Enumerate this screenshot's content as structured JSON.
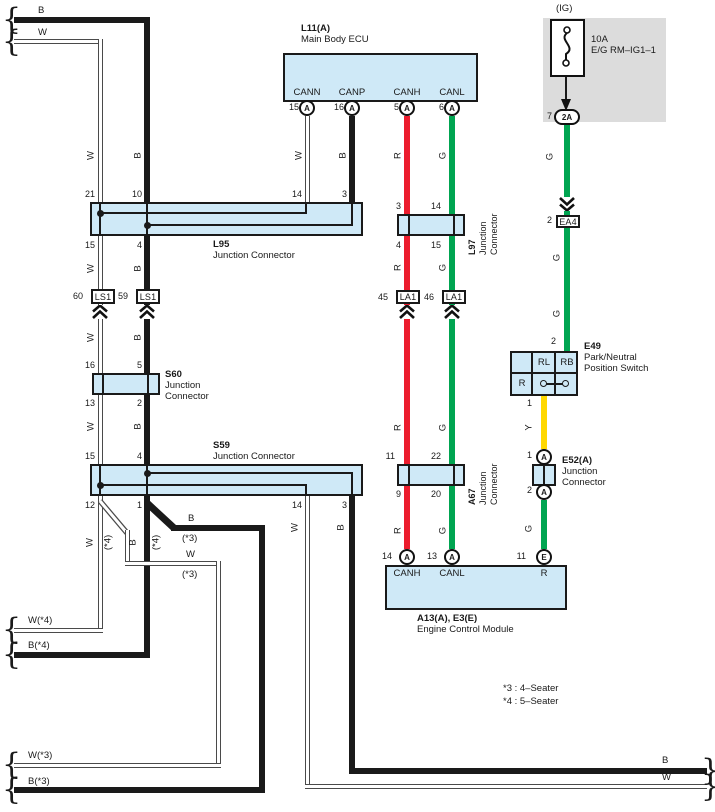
{
  "edge_labels": {
    "top_b": "B",
    "top_w": "W",
    "w4": "W(*4)",
    "b4": "B(*4)",
    "w3": "W(*3)",
    "b3": "B(*3)",
    "bot_b": "B",
    "bot_w": "W"
  },
  "wire_letters": {
    "w": "W",
    "b": "B",
    "r": "R",
    "g": "G",
    "y": "Y"
  },
  "variant_labels": {
    "v3": "(*3)",
    "v4": "(*4)"
  },
  "notes": {
    "n3": "*3 : 4–Seater",
    "n4": "*4 : 5–Seater"
  },
  "fuse": {
    "tag": "(IG)",
    "rating": "10A",
    "name": "E/G RM–IG1–1",
    "pin": "7",
    "terminal": "2A"
  },
  "ea4": {
    "pin": "2",
    "id": "EA4"
  },
  "l11": {
    "id": "L11(A)",
    "name": "Main Body ECU",
    "pins": [
      {
        "num": "15",
        "name": "CANN",
        "term": "A"
      },
      {
        "num": "16",
        "name": "CANP",
        "term": "A"
      },
      {
        "num": "5",
        "name": "CANH",
        "term": "A"
      },
      {
        "num": "6",
        "name": "CANL",
        "term": "A"
      }
    ]
  },
  "l95": {
    "id": "L95",
    "name": "Junction Connector",
    "pins_top": [
      "21",
      "10",
      "14",
      "3"
    ],
    "pins_bottom": [
      "15",
      "4"
    ]
  },
  "l97": {
    "id": "L97",
    "name_line1": "Junction",
    "name_line2": "Connector",
    "pins_top": [
      "3",
      "14"
    ],
    "pins_bottom": [
      "4",
      "15"
    ]
  },
  "ls1_left": {
    "pin": "60",
    "id": "LS1"
  },
  "ls1_right": {
    "pin": "59",
    "id": "LS1"
  },
  "la1_left": {
    "pin": "45",
    "id": "LA1"
  },
  "la1_right": {
    "pin": "46",
    "id": "LA1"
  },
  "s60": {
    "id": "S60",
    "name_line1": "Junction",
    "name_line2": "Connector",
    "pins_top": [
      "16",
      "5"
    ],
    "pins_bottom": [
      "13",
      "2"
    ]
  },
  "s59": {
    "id": "S59",
    "name": "Junction Connector",
    "pins_top": [
      "15",
      "4"
    ],
    "pins_bottom": [
      "12",
      "1",
      "14",
      "3"
    ]
  },
  "a67": {
    "id": "A67",
    "name_line1": "Junction",
    "name_line2": "Connector",
    "pins_top": [
      "11",
      "22"
    ],
    "pins_bottom": [
      "9",
      "20"
    ]
  },
  "e49": {
    "id": "E49",
    "name_line1": "Park/Neutral",
    "name_line2": "Position Switch",
    "pin_in": "2",
    "pin_out": "1",
    "cell_rl": "RL",
    "cell_rb": "RB",
    "cell_r": "R"
  },
  "e52": {
    "id": "E52(A)",
    "name_line1": "Junction",
    "name_line2": "Connector",
    "pin1": "1",
    "pin1_term": "A",
    "pin2": "2",
    "pin2_term": "A"
  },
  "ecm": {
    "id": "A13(A), E3(E)",
    "name": "Engine Control Module",
    "pins": [
      {
        "num": "14",
        "term": "A",
        "name": "CANH"
      },
      {
        "num": "13",
        "term": "A",
        "name": "CANL"
      },
      {
        "num": "11",
        "term": "E",
        "name": "R"
      }
    ]
  },
  "colors": {
    "can_high_red": "#ec1c2d",
    "can_low_green": "#00a551",
    "ignition_green": "#00a551",
    "neutral_yellow": "#ffd800",
    "connector_fill": "#cfe9f7",
    "fuse_block_gray": "#dcdcdc",
    "wire_black": "#1a1a1a"
  }
}
